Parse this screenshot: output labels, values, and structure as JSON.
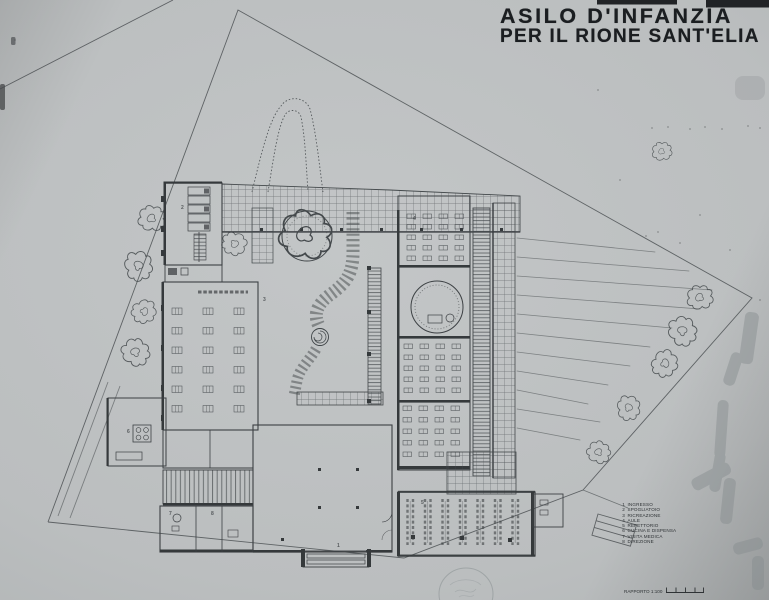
{
  "title": {
    "line1": "ASILO D'INFANZIA",
    "line2": "PER IL RIONE SANT'ELIA"
  },
  "legend": {
    "items": [
      {
        "num": "1",
        "label": "INGRESSO"
      },
      {
        "num": "2",
        "label": "SPOGLIATOIO"
      },
      {
        "num": "3",
        "label": "RICREAZIONE"
      },
      {
        "num": "4",
        "label": "AULE"
      },
      {
        "num": "5",
        "label": "REFETTORIO"
      },
      {
        "num": "6",
        "label": "CUCINA E DISPENSA"
      },
      {
        "num": "7",
        "label": "VISITA MEDICA"
      },
      {
        "num": "8",
        "label": "DIREZIONE"
      }
    ]
  },
  "scale": {
    "label": "RAPPORTO 1:100"
  },
  "plan": {
    "room_markers": [
      {
        "num": "1",
        "x": 337,
        "y": 547
      },
      {
        "num": "2",
        "x": 181,
        "y": 209
      },
      {
        "num": "3",
        "x": 263,
        "y": 301
      },
      {
        "num": "4",
        "x": 413,
        "y": 220
      },
      {
        "num": "5",
        "x": 421,
        "y": 504
      },
      {
        "num": "6",
        "x": 127,
        "y": 433
      },
      {
        "num": "7",
        "x": 169,
        "y": 515
      },
      {
        "num": "8",
        "x": 211,
        "y": 515
      }
    ]
  },
  "colors": {
    "paper": "#bcbfc0",
    "ink": "#34383b",
    "title_ink": "#1b1e21"
  }
}
